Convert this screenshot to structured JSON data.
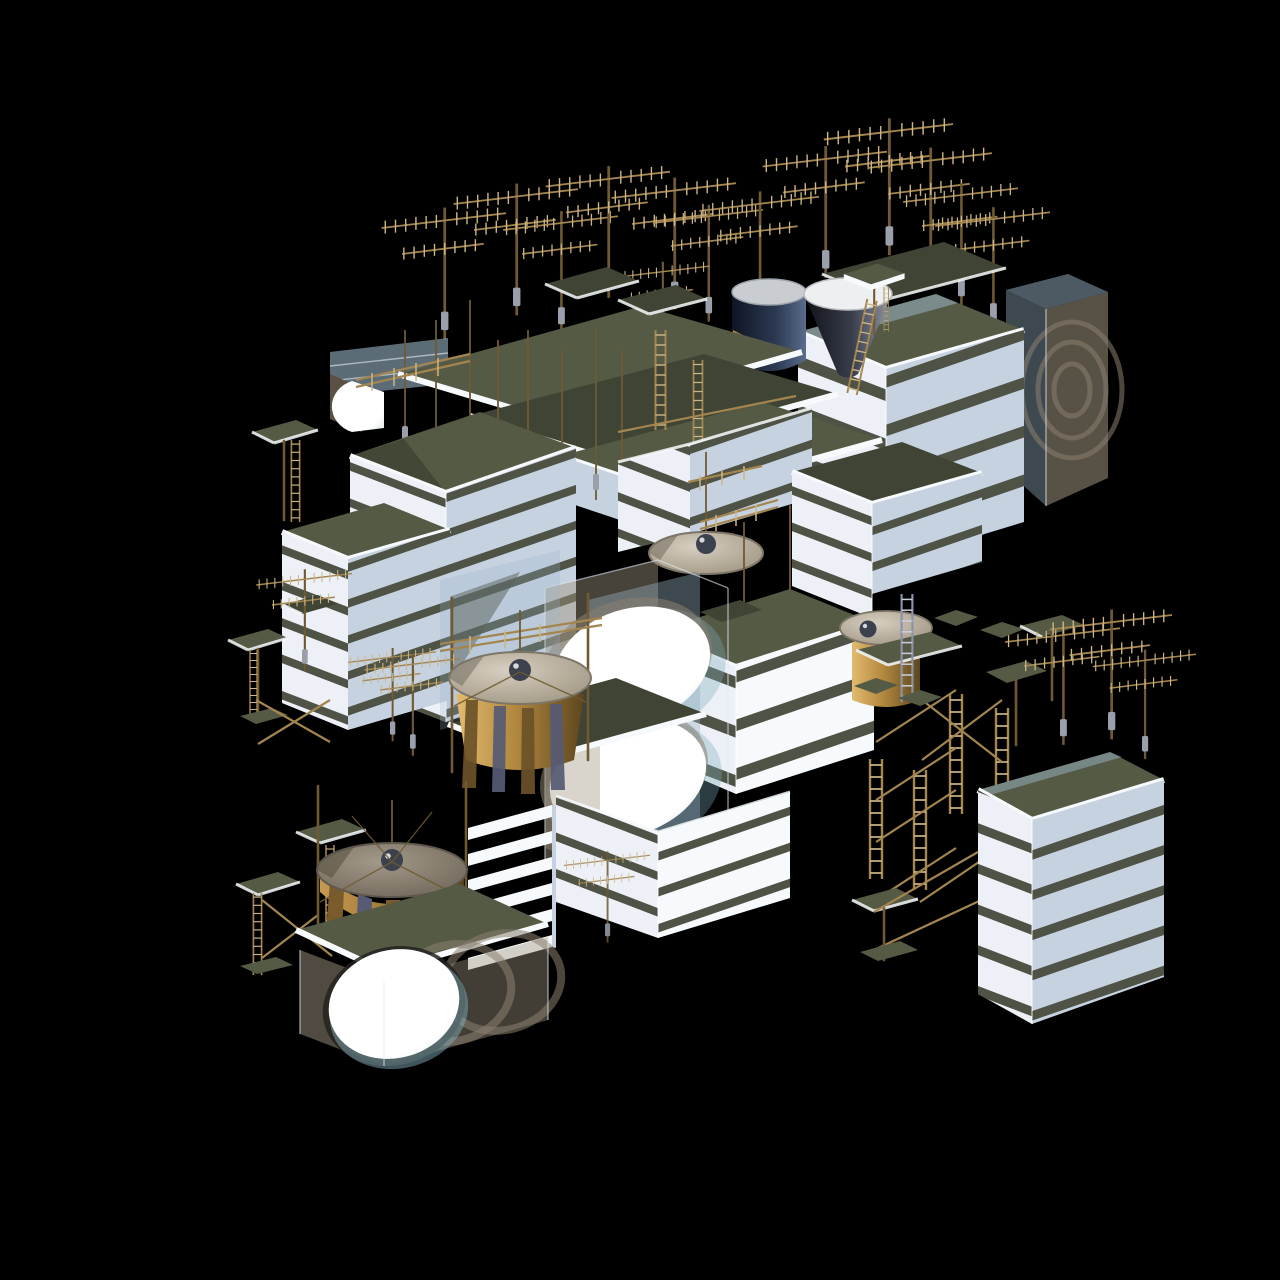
{
  "scene": {
    "background": "#000000",
    "palette": {
      "bg": "#000000",
      "face-white": "#edf1f7",
      "face-white-2": "#f7fafc",
      "face-blue": "#c6d2e0",
      "face-blue-2": "#aebdd0",
      "band": "#4e5345",
      "roof": "#555a45",
      "roof-dark": "#3f4434",
      "fascia": "#f7fafc",
      "glass-blue": "#9ab4c6",
      "glass-beige": "#a0947f",
      "glass-teal": "#7fa9b6",
      "glow-white": "#ffffff",
      "tan": "#a3854f",
      "tan-light": "#cdb684",
      "tan-dark": "#6f5a33",
      "steel": "#8b93a8",
      "bronze-light": "#e2bb70",
      "bronze-mid": "#b3893f",
      "bronze-dark": "#5d461f",
      "disc-light": "#d6cec0",
      "disc-mid": "#9d937f",
      "disc-dark": "#6d6557",
      "sphere-dark": "#3c414e",
      "navy-dark": "#161f30",
      "navy-light": "#5a6c8c",
      "cone-dark": "#101218",
      "cone-light": "#9298a8",
      "arch-brown": "#5a5043",
      "arc-gray": "#8b8070",
      "pole-base": "#9aa0ab"
    },
    "inventory": {
      "banded_buildings": 8,
      "rooftop_aerial_antennas": 19,
      "ladders": 16,
      "water_tanks_with_disc_tops": 4,
      "silo_cones": 1,
      "dark_cylindrical_tanks": 1,
      "glass_volumes": 3,
      "glowing_circular_openings": 4,
      "platform_stands": 9,
      "scaffold_truss_towers": 4,
      "roof_decks": 5
    }
  }
}
